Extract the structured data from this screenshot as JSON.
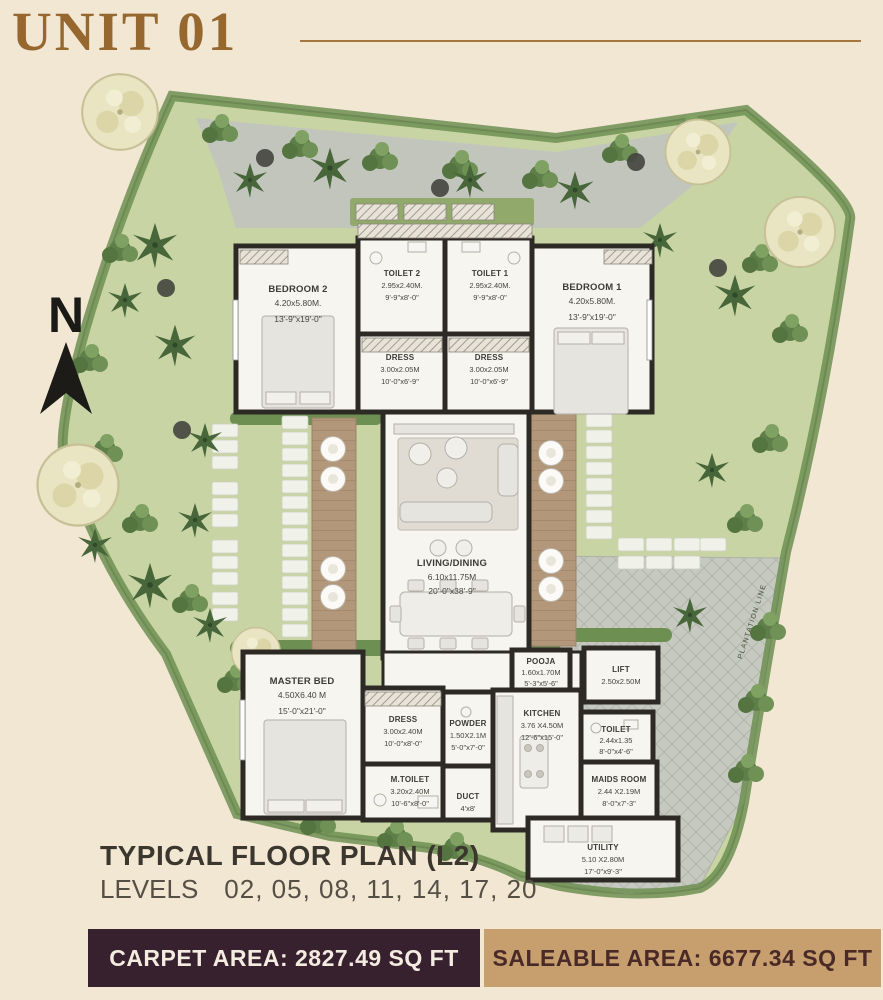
{
  "page": {
    "title": "UNIT 01"
  },
  "compass": {
    "label": "N"
  },
  "plan": {
    "plantation_line": "PLANTATION LINE",
    "rooms": [
      {
        "name": "BEDROOM 2",
        "dim_m": "4.20x5.80M.",
        "dim_ft": "13'-9\"x19'-0\""
      },
      {
        "name": "TOILET 2",
        "dim_m": "2.95x2.40M.",
        "dim_ft": "9'-9\"x8'-0\""
      },
      {
        "name": "TOILET 1",
        "dim_m": "2.95x2.40M.",
        "dim_ft": "9'-9\"x8'-0\""
      },
      {
        "name": "BEDROOM 1",
        "dim_m": "4.20x5.80M.",
        "dim_ft": "13'-9\"x19'-0\""
      },
      {
        "name": "DRESS",
        "dim_m": "3.00x2.05M",
        "dim_ft": "10'-0\"x6'-9\""
      },
      {
        "name": "DRESS",
        "dim_m": "3.00x2.05M",
        "dim_ft": "10'-0\"x6'-9\""
      },
      {
        "name": "LIVING/DINING",
        "dim_m": "6.10x11.75M",
        "dim_ft": "20'-0\"x38'-9\""
      },
      {
        "name": "MASTER BED",
        "dim_m": "4.50X6.40 M",
        "dim_ft": "15'-0\"x21'-0\""
      },
      {
        "name": "DRESS",
        "dim_m": "3.00x2.40M",
        "dim_ft": "10'-0\"x8'-0\""
      },
      {
        "name": "POWDER",
        "dim_m": "1.50X2.1M",
        "dim_ft": "5'-0\"x7'-0\""
      },
      {
        "name": "M.TOILET",
        "dim_m": "3.20x2.40M",
        "dim_ft": "10'-6\"x8'-0\""
      },
      {
        "name": "DUCT",
        "dim_ft": "4'x8'"
      },
      {
        "name": "KITCHEN",
        "dim_m": "3.76 X4.50M",
        "dim_ft": "12'-6\"x15'-0\""
      },
      {
        "name": "POOJA",
        "dim_m": "1.60x1.70M",
        "dim_ft": "5'-3\"x5'-6\""
      },
      {
        "name": "LIFT",
        "dim_m": "2.50x2.50M"
      },
      {
        "name": "TOILET",
        "dim_m": "2.44x1.35",
        "dim_ft": "8'-0\"x4'-6\""
      },
      {
        "name": "MAIDS ROOM",
        "dim_m": "2.44 X2.19M",
        "dim_ft": "8'-0\"x7'-3\""
      },
      {
        "name": "UTILITY",
        "dim_m": "5.10 X2.80M",
        "dim_ft": "17'-0\"x9'-3\""
      }
    ]
  },
  "footer": {
    "plan_title": "TYPICAL FLOOR PLAN (L2)",
    "levels_label": "LEVELS",
    "levels_values": "02, 05, 08, 11, 14, 17, 20"
  },
  "banners": {
    "carpet": {
      "text": "CARPET AREA: 2827.49 SQ FT",
      "bg": "#38212f"
    },
    "saleable": {
      "text": "SALEABLE AREA: 6677.34 SQ FT",
      "bg": "#c79e6e"
    }
  },
  "colors": {
    "background": "#f1e7d2",
    "title_brown": "#96672f",
    "lawn_green": "#c9d4a4",
    "hedge_green": "#6d8f52",
    "wall_dark": "#2d2a26",
    "path_gray": "#c2c5bc",
    "deck_wood": "#b2977a"
  }
}
